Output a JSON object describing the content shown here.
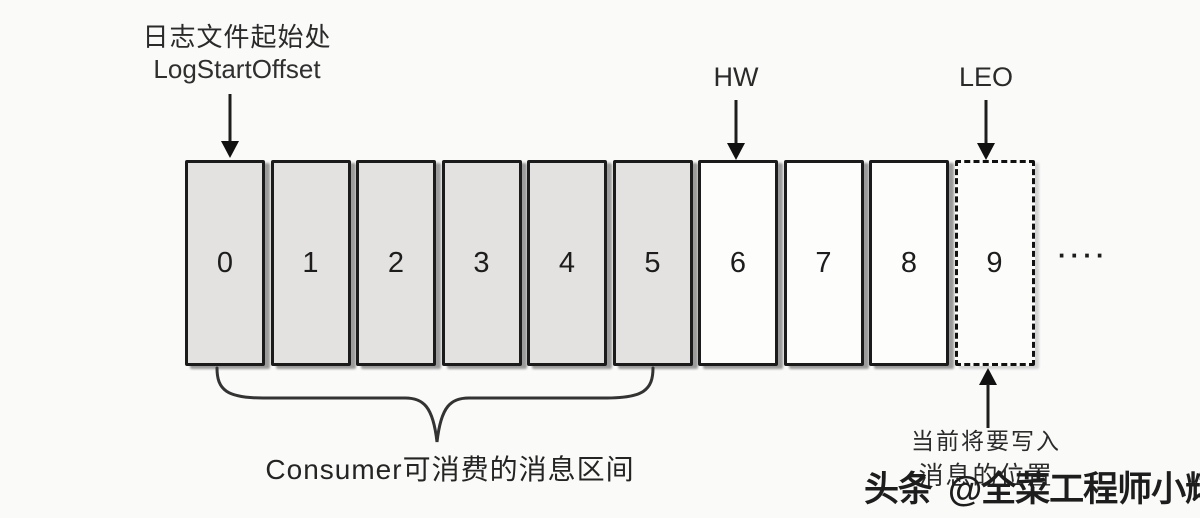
{
  "diagram": {
    "log_start_offset": {
      "label_zh": "日志文件起始处",
      "label_en": "LogStartOffset"
    },
    "hw_label": "HW",
    "leo_label": "LEO",
    "cell_labels": [
      "0",
      "1",
      "2",
      "3",
      "4",
      "5",
      "6",
      "7",
      "8",
      "9"
    ],
    "cell_states": {
      "consumable_range": [
        0,
        5
      ],
      "beyond_hw_range": [
        6,
        8
      ],
      "next_write_cell": 9
    },
    "ellipsis": "····",
    "consumer_range_label": "Consumer可消费的消息区间",
    "write_position": {
      "line1": "当前将要写入",
      "line2": "消息的位置"
    },
    "watermark": {
      "prefix": "头条",
      "handle": "@全菜工程师小辉"
    },
    "colors": {
      "background": "#fafaf9",
      "cell_gray_fill": "#e3e2e0",
      "cell_white_fill": "#fdfdfc",
      "line_dark": "#1b1b1b",
      "text_dark": "#262626"
    }
  }
}
